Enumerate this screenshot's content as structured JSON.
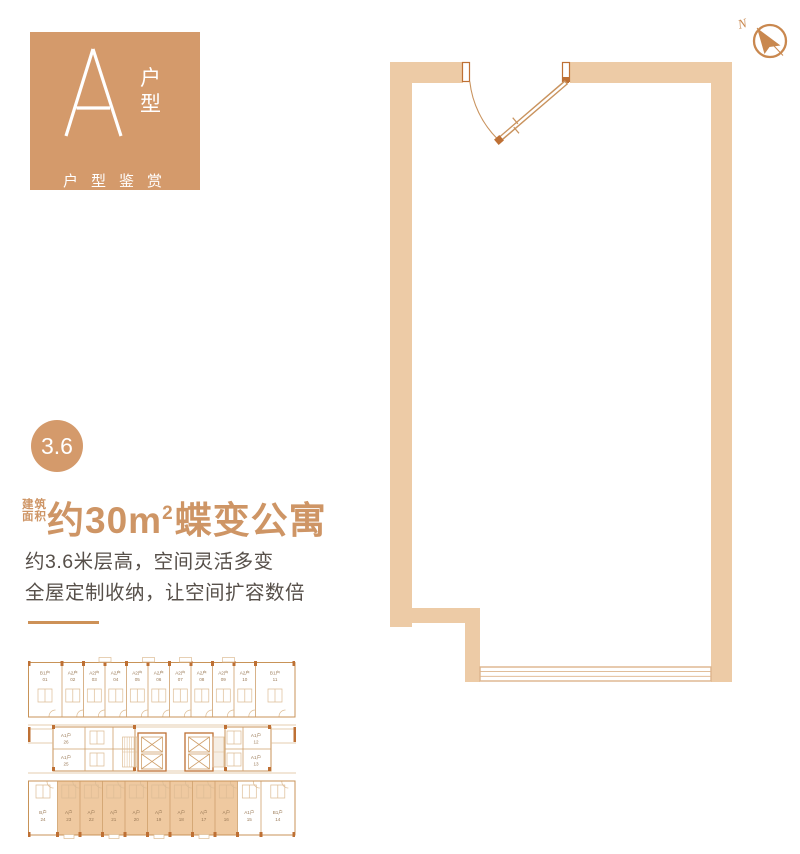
{
  "badge": {
    "letter": "A",
    "vertical": [
      "户",
      "型"
    ],
    "subtitle": "户型鉴赏"
  },
  "height_badge": "3.6",
  "area_title": {
    "prefix_line1": "建筑",
    "prefix_line2": "面积",
    "main": "约30m",
    "sup": "2",
    "suffix": "蝶变公寓"
  },
  "description": [
    "约3.6米层高，空间灵活多变",
    "全屋定制收纳，让空间扩容数倍"
  ],
  "compass_label": "N",
  "key_plan": {
    "top": [
      {
        "t": "B1户",
        "n": "01"
      },
      {
        "t": "A2户",
        "n": "02"
      },
      {
        "t": "A2户",
        "n": "03"
      },
      {
        "t": "A2户",
        "n": "04"
      },
      {
        "t": "A2户",
        "n": "05"
      },
      {
        "t": "A2户",
        "n": "06"
      },
      {
        "t": "A2户",
        "n": "07"
      },
      {
        "t": "A2户",
        "n": "08"
      },
      {
        "t": "A2户",
        "n": "09"
      },
      {
        "t": "A2户",
        "n": "10"
      },
      {
        "t": "B1户",
        "n": "11"
      }
    ],
    "middle": [
      {
        "t": "A1户",
        "n": "26"
      },
      {
        "t": "A1户",
        "n": "25"
      },
      {
        "t": "A1户",
        "n": "12"
      },
      {
        "t": "A1户",
        "n": "13"
      }
    ],
    "bottom": [
      {
        "t": "B户",
        "n": "24"
      },
      {
        "t": "A户",
        "n": "23"
      },
      {
        "t": "A户",
        "n": "22"
      },
      {
        "t": "A户",
        "n": "21"
      },
      {
        "t": "A户",
        "n": "20"
      },
      {
        "t": "A户",
        "n": "19"
      },
      {
        "t": "A户",
        "n": "18"
      },
      {
        "t": "A户",
        "n": "17"
      },
      {
        "t": "A户",
        "n": "16"
      },
      {
        "t": "A1户",
        "n": "15"
      },
      {
        "t": "B1户",
        "n": "14"
      }
    ]
  },
  "colors": {
    "accent": "#D49A6B",
    "wall": "#EDCBA6",
    "title_orange": "#CE9565",
    "body_text": "#57504A",
    "plan_line": "#C9935E",
    "keyplan_highlight": "#EFC9A0",
    "dark_pier": "#BE7034"
  }
}
